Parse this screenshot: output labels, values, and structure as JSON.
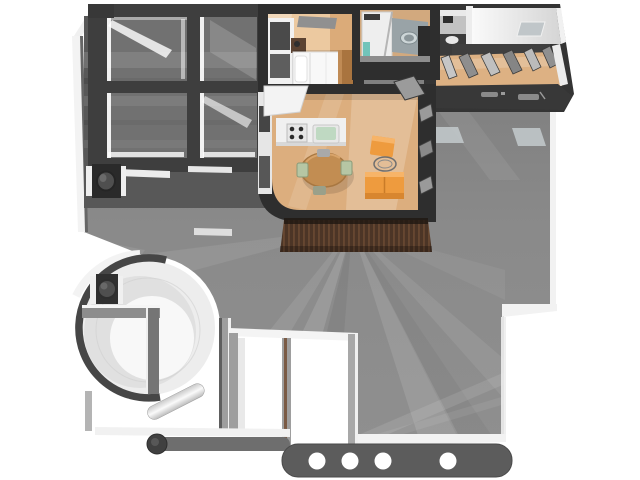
{
  "colors": {
    "bg": "#ffffff",
    "outline": "#2e2e2e",
    "frame": "#3e3e3e",
    "band": "#383838",
    "roofBase": "#888888",
    "roofTop": "#7b7b7b",
    "underGlass": "#585858",
    "glass": "#a0a0a0",
    "whiteEdge": "#f2f2f2",
    "mullion": "#ffffff",
    "ring": "#464646",
    "circleFill": "#ededed",
    "circleShade": "#dcdcdc",
    "circleCore": "#f8f8f8",
    "wallGray": "#9e9e9e",
    "wallLight": "#b4b4b4",
    "barGray": "#6e6e6e",
    "footerBand": "#5c5c5c",
    "dot": "#ffffff",
    "floorBedroom": "#ecc9a0",
    "floorLiving": "#dcae7e",
    "floorHall": "#ddb183",
    "woodDark": "#a9743f",
    "woodMid": "#c28d52",
    "rug": "#909090",
    "counter": "#f0f0f0",
    "sinkTeal": "#bfd9c2",
    "burner": "#2b2b2b",
    "sofa": "#ee9b3e",
    "sofaDark": "#d8862f",
    "sofaLight": "#f7b468",
    "chairSage": "#b6c6a4",
    "bathCounter": "#99a3a7",
    "basin": "#cdd6d8",
    "tealAccent": "#72c4ba",
    "deckDark": "#4c3526",
    "deckLight": "#6d4b33",
    "panelLight": "#c6c6c6",
    "panelMid": "#8e8e8e",
    "vanity": "#3b3b3b",
    "skylightPatch": "#c0c6c9",
    "knob": "#4f4f4f"
  },
  "footer": {
    "dot_count": 4,
    "dot_positions": [
      317,
      350,
      383,
      448
    ]
  }
}
